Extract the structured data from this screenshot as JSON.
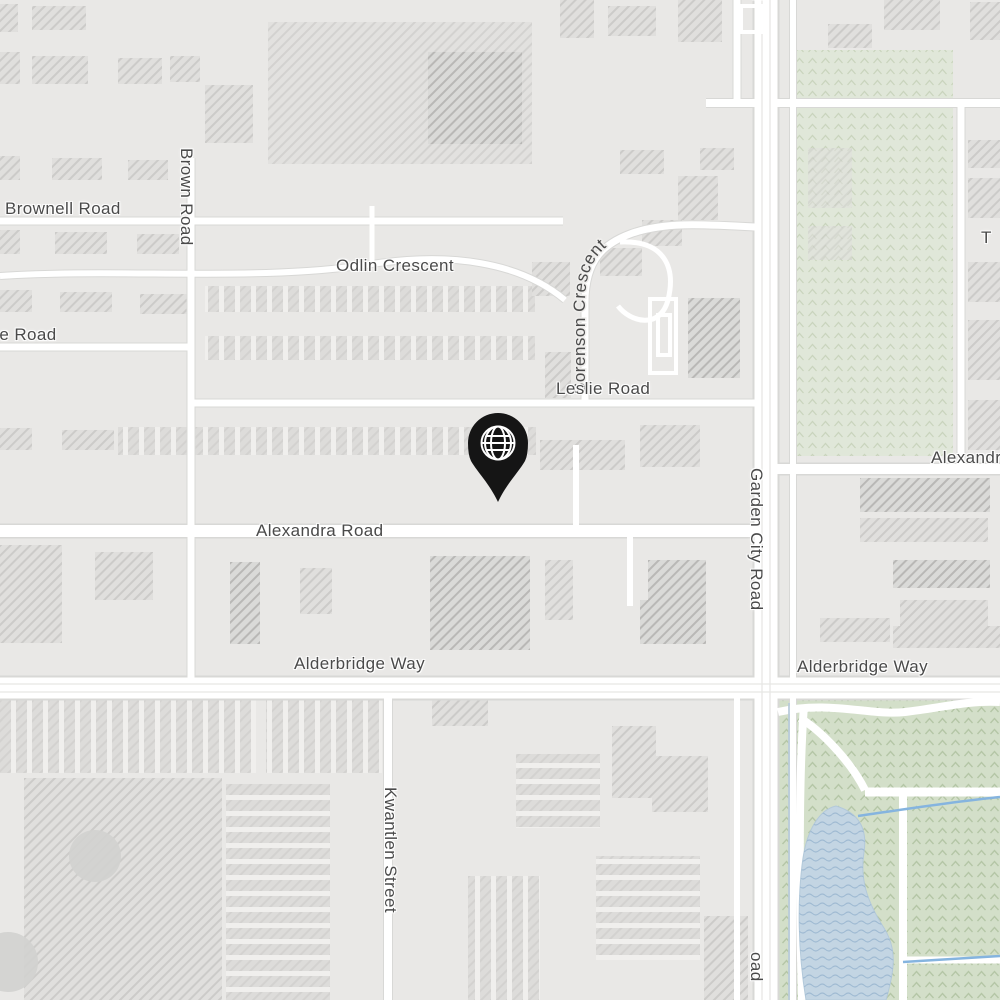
{
  "map": {
    "labels": {
      "brownell_road": "Brownell Road",
      "brown_road": "Brown Road",
      "leslie_road_west_partial": "lie Road",
      "odlin_crescent": "Odlin Crescent",
      "sorenson_crescent": "Sorenson Crescent",
      "leslie_road": "Leslie Road",
      "alexandra_road": "Alexandra Road",
      "alexandra_road_east_partial": "Alexandr",
      "garden_city_road": "Garden City Road",
      "garden_city_road_top_fragment": "d",
      "garden_city_road_bottom_fragment": "oad",
      "alderbridge_way_west": "Alderbridge Way",
      "alderbridge_way_east": "Alderbridge Way",
      "kwantlen_street": "Kwantlen Street",
      "east_edge_fragment": "T"
    },
    "marker": {
      "icon": "globe-icon",
      "color": "#151515",
      "x": 498,
      "y": 443
    },
    "colors": {
      "land": "#e9e8e6",
      "road": "#ffffff",
      "road_casing": "#d8d8d6",
      "building_hatch": "#c9c8c6",
      "park_light": "#e0e7d9",
      "park_green": "#d3dfc9",
      "park_pattern": "#b4c6a6",
      "water": "#c3d5e3",
      "stream": "#85b4df",
      "label_text": "#4a4a4a"
    }
  }
}
